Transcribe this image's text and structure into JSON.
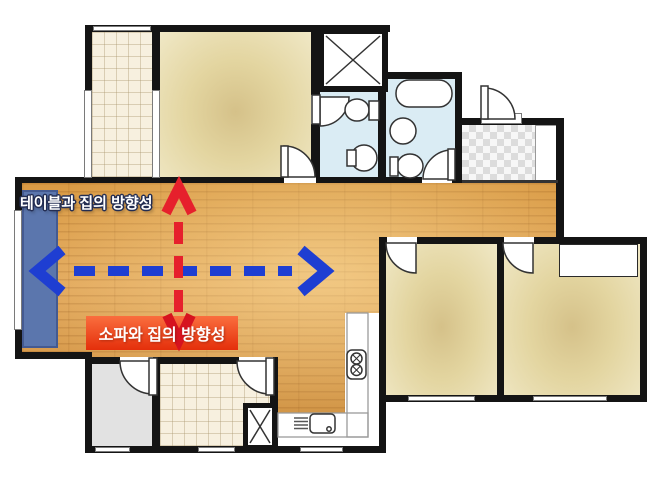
{
  "annotations": {
    "table_direction": {
      "text": "테이블과 집의 방향성",
      "text_color": "#ffffff",
      "outline_color": "#232d52"
    },
    "sofa_direction": {
      "text": "소파와 집의 방향성",
      "text_color": "#ffffff",
      "bg_color": "#ec3a10"
    }
  },
  "arrows": {
    "horizontal_blue": {
      "color": "#1e3ed2",
      "style": "dashed",
      "heads": "both",
      "orientation": "horizontal"
    },
    "vertical_red": {
      "color": "#e6202c",
      "style": "dashed",
      "heads": "both",
      "orientation": "vertical"
    }
  },
  "palette": {
    "wall": "#141414",
    "wood_floor": "#dfa052",
    "room_beige": "#e9dcab",
    "bathroom_blue": "#daecf4",
    "tile_cream": "#f6efde",
    "gray_room": "#e2e2e2",
    "sofa_blue": "#5b76ad",
    "entrance_checker": "#e2e2e2"
  }
}
